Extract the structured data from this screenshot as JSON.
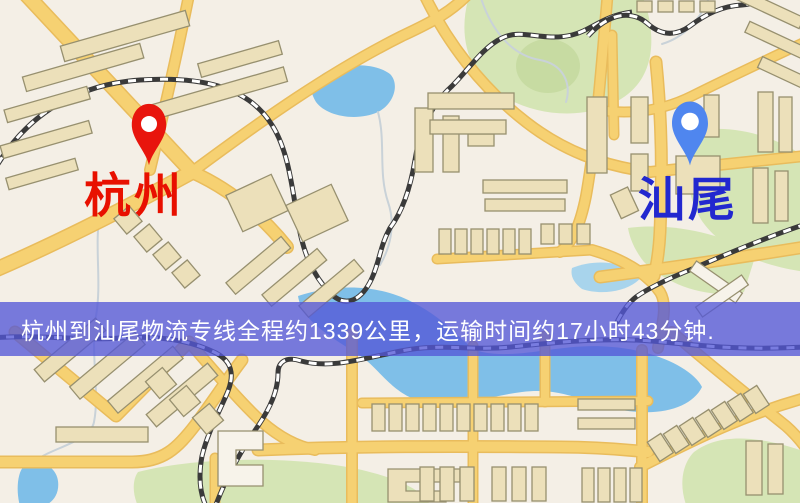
{
  "map": {
    "origin": {
      "name": "杭州"
    },
    "destination": {
      "name": "汕尾"
    }
  },
  "banner": {
    "text": "杭州到汕尾物流专线全程约1339公里，运输时间约17小时43分钟."
  },
  "colors": {
    "map_background": "#f4efe6",
    "road_fill": "#f6d172",
    "road_casing": "#e9bc5c",
    "building_fill": "#ece0ba",
    "building_stroke": "#97906f",
    "building_light": "#f7f3ea",
    "park_green": "#d5e5b5",
    "park_green_dark": "#c7dba2",
    "water_blue": "#7fbfe8",
    "water_blue_light": "#a8d4ec",
    "stream_gray": "#c9d2d8",
    "railway_dark": "#3a3a3a",
    "railway_tie": "#ffffff",
    "banner_bg": "rgba(83,87,215,0.78)",
    "banner_text": "#ffffff",
    "pin_red": "#e8150d",
    "pin_blue": "#4f86ef",
    "label_red": "#e81000",
    "label_blue": "#2228cf"
  }
}
